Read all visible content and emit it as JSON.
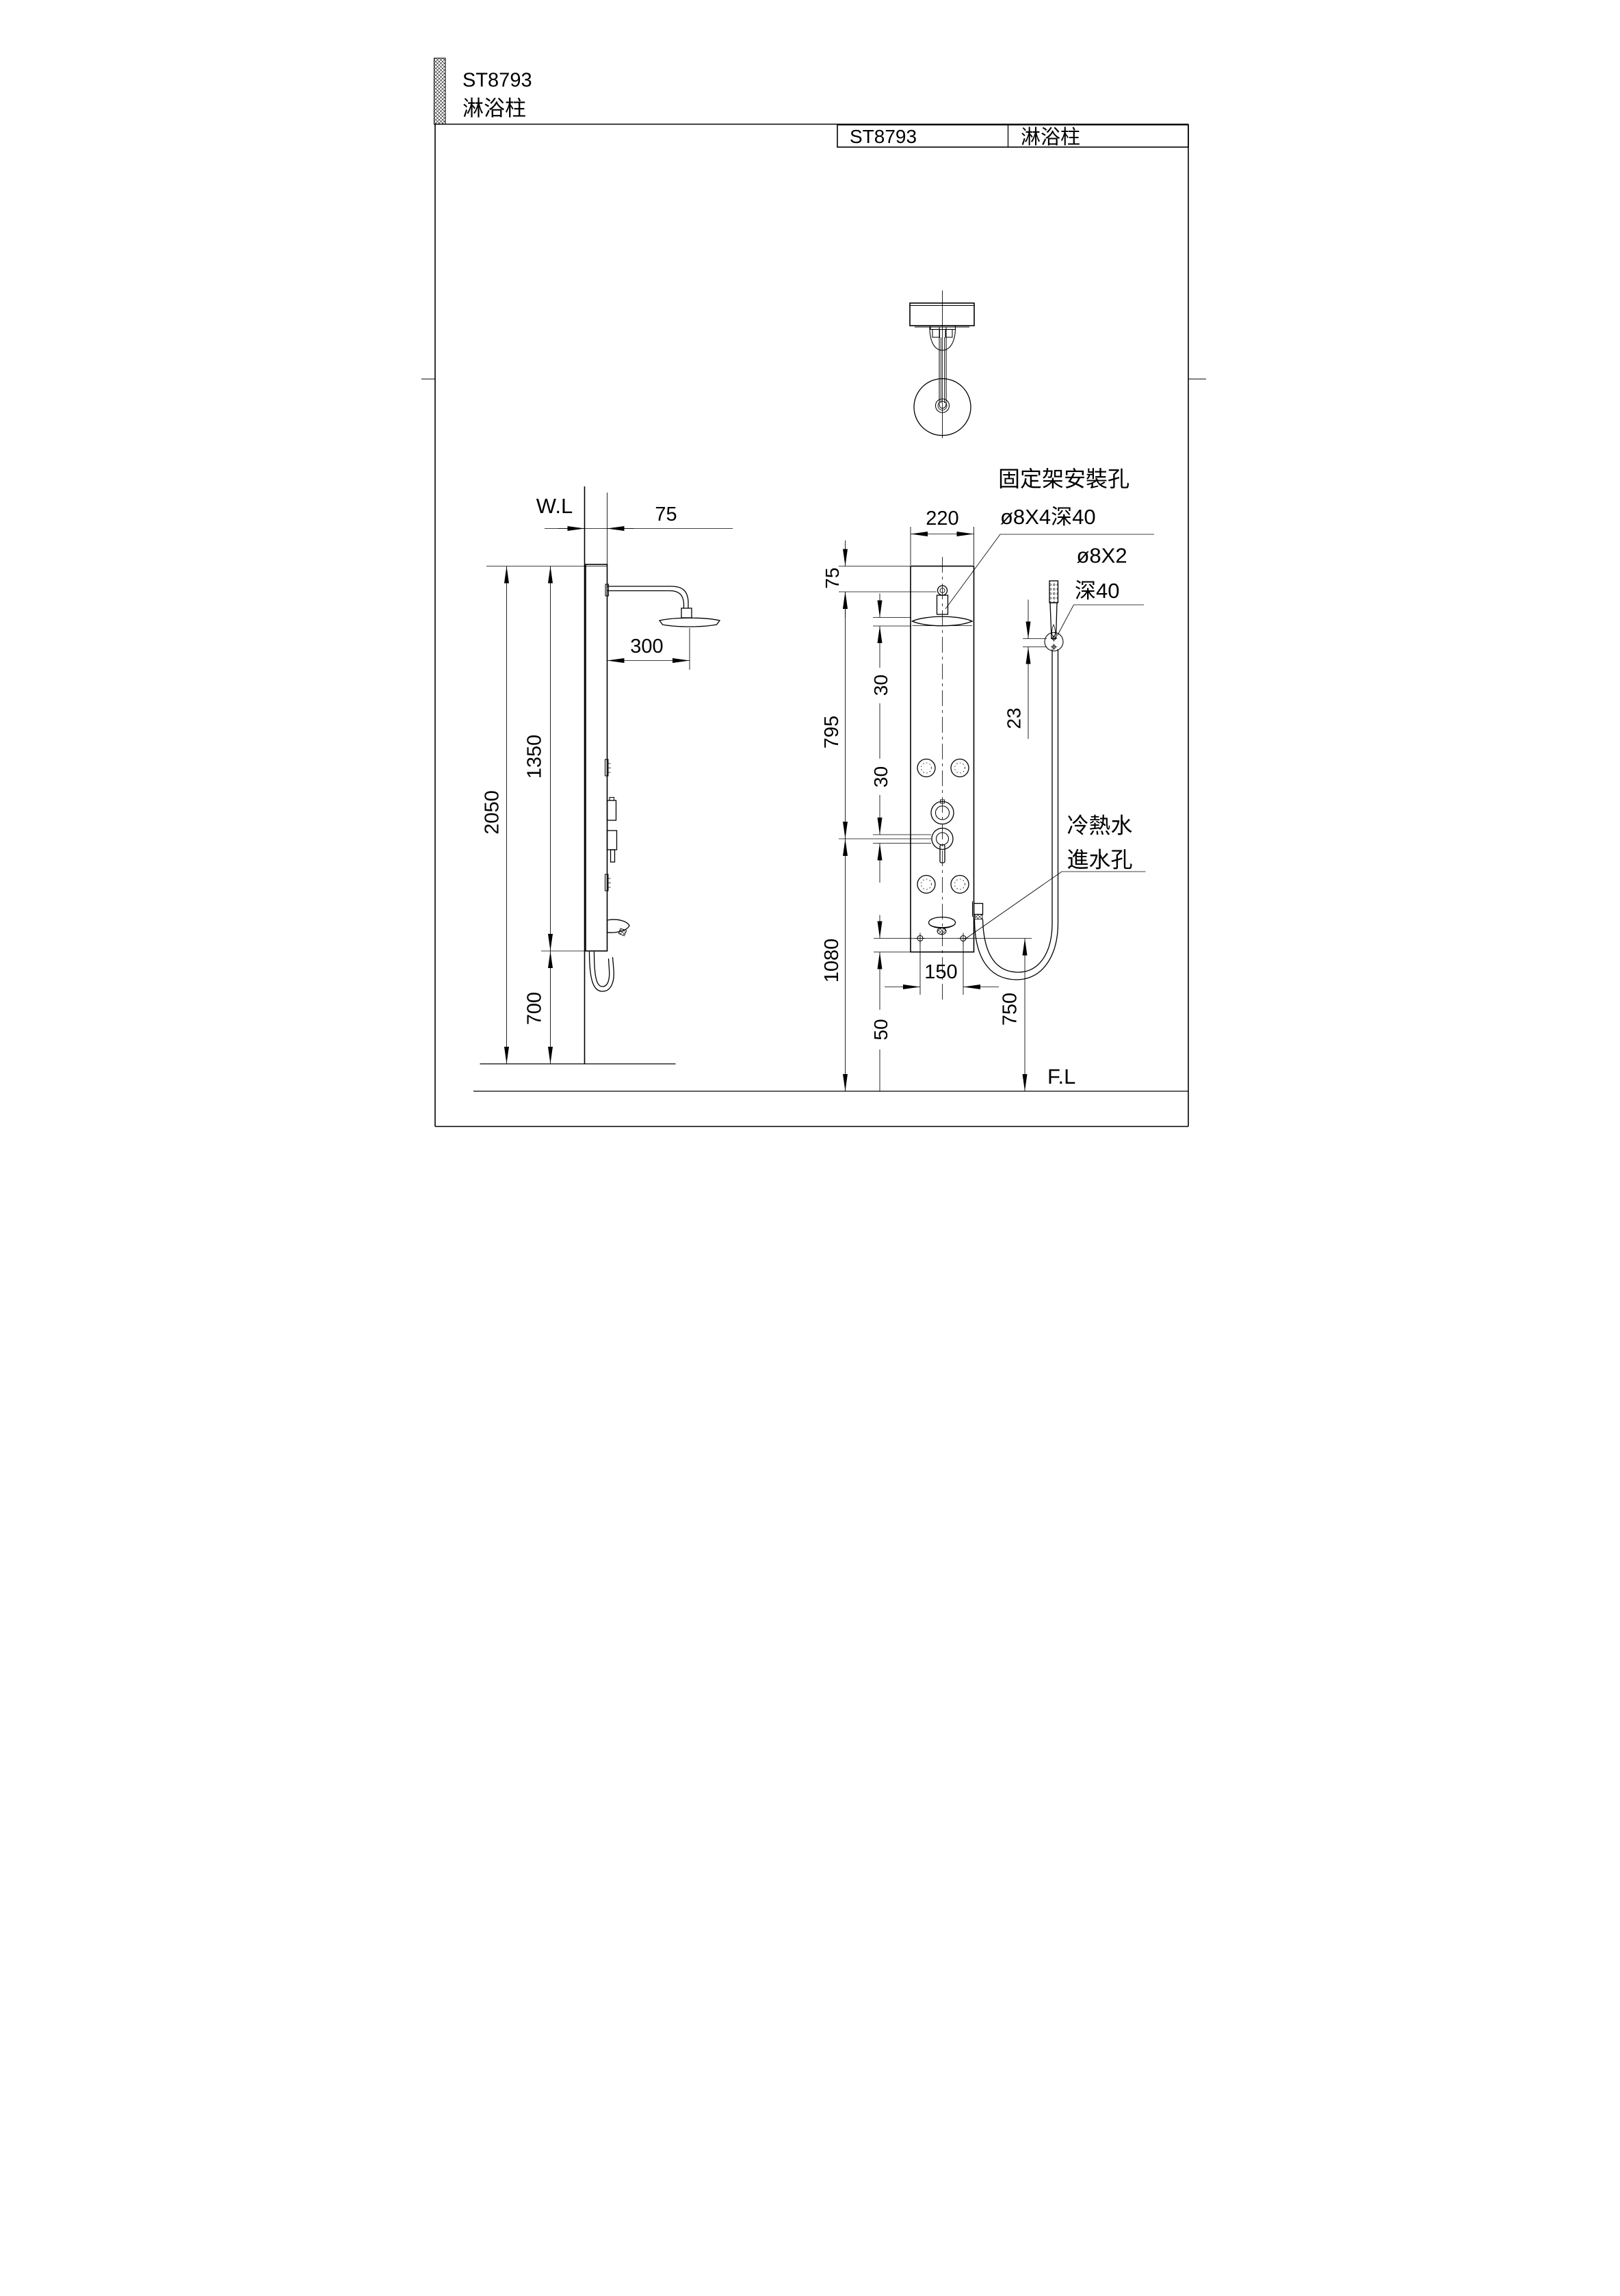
{
  "header": {
    "model": "ST8793",
    "product_name": "淋浴柱"
  },
  "title_block": {
    "model": "ST8793",
    "product_name": "淋浴柱"
  },
  "side_view": {
    "wall_line_label": "W.L",
    "dim_wall_offset": "75",
    "dim_arm_length": "300",
    "dim_panel_height": "1350",
    "dim_total_height": "2050",
    "dim_bottom_height": "700"
  },
  "front_view": {
    "dim_panel_width": "220",
    "dim_top_to_bracket": "75",
    "dim_bracket_to_valve": "795",
    "dim_valve_to_floor": "1080",
    "dim_jet_offset_upper": "30",
    "dim_jet_offset_lower": "30",
    "dim_inlet_to_bottom": "50",
    "dim_inlet_spacing": "150",
    "dim_inlet_height": "750",
    "dim_holder_holes": "23",
    "floor_line_label": "F.L"
  },
  "annotations": {
    "bracket_note_line1": "固定架安裝孔",
    "bracket_note_line2": "ø8X4深40",
    "handshower_note_line1": "ø8X2",
    "handshower_note_line2": "深40",
    "inlet_note_line1": "冷熱水",
    "inlet_note_line2": "進水孔"
  },
  "colors": {
    "line": "#000000",
    "background": "#ffffff"
  }
}
